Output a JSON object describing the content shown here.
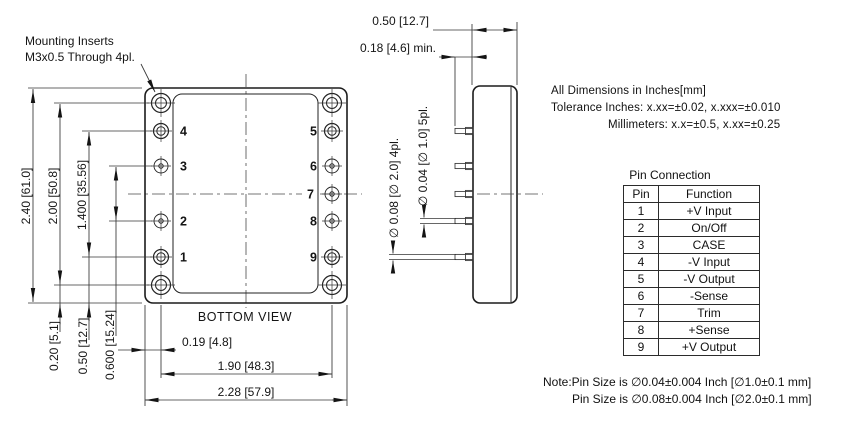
{
  "drawing": {
    "mounting_note": {
      "line1": "Mounting Inserts",
      "line2": "M3x0.5 Through 4pl."
    },
    "bottom_view": {
      "caption": "BOTTOM VIEW",
      "pin_numbers_left": [
        "4",
        "3",
        "2",
        "1"
      ],
      "pin_numbers_right": [
        "5",
        "6",
        "7",
        "8",
        "9"
      ],
      "dims_left": [
        "2.40 [61.0]",
        "2.00 [50.8]",
        "1.400 [35.56]"
      ],
      "dims_bottom_left": [
        "0.20 [5.1]",
        "0.50 [12.7]",
        "0.600 [15.24]"
      ],
      "dims_bottom": [
        "0.19 [4.8]",
        "1.90 [48.3]",
        "2.28 [57.9]"
      ]
    },
    "side_view": {
      "dim_depth": "0.50 [12.7]",
      "dim_pin_length": "0.18 [4.6] min.",
      "dim_pin_small": "∅ 0.04 [∅ 1.0] 5pl.",
      "dim_pin_large": "∅ 0.08 [∅ 2.0] 4pl."
    }
  },
  "tolerance_block": {
    "line1": "All Dimensions in Inches[mm]",
    "tolerance_label": "Tolerance",
    "inches_tolerance": "Inches: x.xx=±0.02, x.xxx=±0.010",
    "mm_tolerance": "Millimeters: x.x=±0.5, x.xx=±0.25"
  },
  "pin_table": {
    "title": "Pin Connection",
    "headers": [
      "Pin",
      "Function"
    ],
    "rows": [
      [
        "1",
        "+V Input"
      ],
      [
        "2",
        "On/Off"
      ],
      [
        "3",
        "CASE"
      ],
      [
        "4",
        "-V Input"
      ],
      [
        "5",
        "-V Output"
      ],
      [
        "6",
        "-Sense"
      ],
      [
        "7",
        "Trim"
      ],
      [
        "8",
        "+Sense"
      ],
      [
        "9",
        "+V Output"
      ]
    ]
  },
  "notes": {
    "line1": "Note:Pin Size is ∅0.04±0.004 Inch [∅1.0±0.1 mm]",
    "line2": "Pin Size is ∅0.08±0.004 Inch [∅2.0±0.1 mm]"
  }
}
